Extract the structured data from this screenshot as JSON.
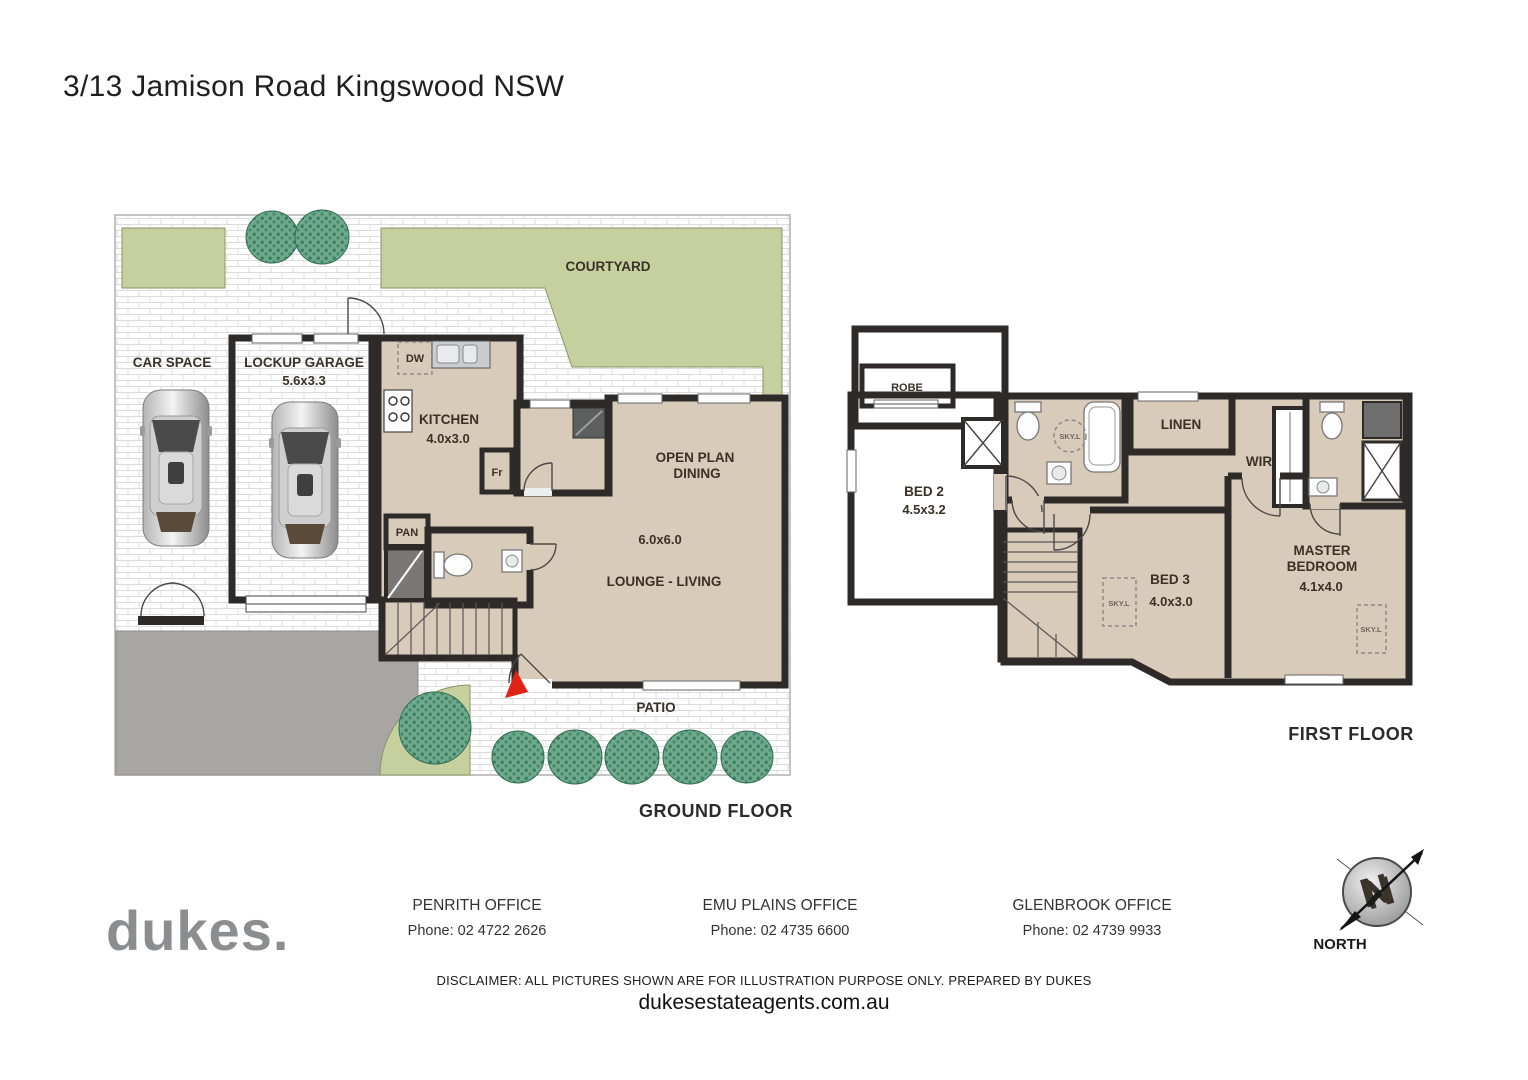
{
  "title": "3/13 Jamison Road Kingswood NSW",
  "ground_floor": {
    "label": "GROUND FLOOR",
    "courtyard": "COURTYARD",
    "car_space": "CAR SPACE",
    "garage": "LOCKUP GARAGE",
    "garage_dims": "5.6x3.3",
    "kitchen": "KITCHEN",
    "kitchen_dims": "4.0x3.0",
    "dishwasher": "DW",
    "fridge": "Fr",
    "pantry": "PAN",
    "open_plan_line1": "OPEN PLAN",
    "open_plan_line2": "DINING",
    "living_dims": "6.0x6.0",
    "lounge": "LOUNGE - LIVING",
    "patio": "PATIO"
  },
  "first_floor": {
    "label": "FIRST FLOOR",
    "robe": "ROBE",
    "bed2": "BED 2",
    "bed2_dims": "4.5x3.2",
    "linen": "LINEN",
    "wir": "WIR",
    "master_line1": "MASTER",
    "master_line2": "BEDROOM",
    "master_dims": "4.1x4.0",
    "bed3": "BED 3",
    "bed3_dims": "4.0x3.0",
    "skylight": "SKY.L"
  },
  "compass": {
    "label": "NORTH"
  },
  "footer": {
    "logo": "dukes.",
    "offices": [
      {
        "name": "PENRITH OFFICE",
        "phone": "Phone: 02 4722 2626"
      },
      {
        "name": "EMU PLAINS OFFICE",
        "phone": "Phone: 02 4735 6600"
      },
      {
        "name": "GLENBROOK OFFICE",
        "phone": "Phone: 02 4739 9933"
      }
    ],
    "disclaimer": "DISCLAIMER: ALL PICTURES SHOWN ARE FOR ILLUSTRATION PURPOSE ONLY. PREPARED BY DUKES",
    "website": "dukesestateagents.com.au"
  },
  "colors": {
    "floor": "#d9cbba",
    "courtyard": "#c6cf9e",
    "wall": "#2d2a28",
    "garage_floor": "#b9b7b5",
    "driveway": "#a8a6a3",
    "tree": "#6fa98c",
    "arrow_red": "#e02318"
  }
}
